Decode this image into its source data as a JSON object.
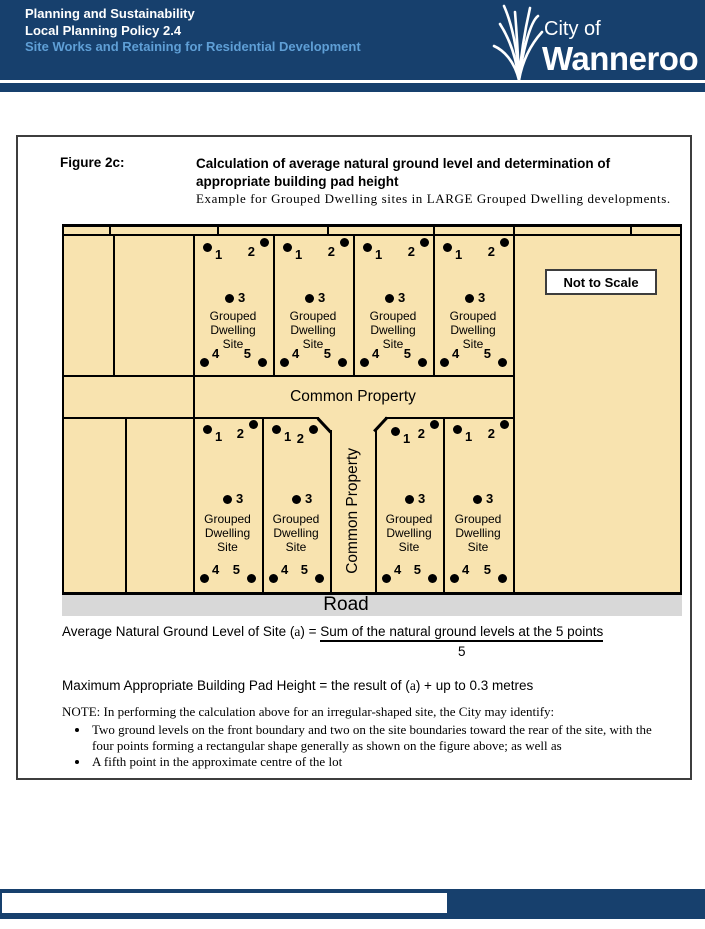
{
  "header": {
    "line1": "Planning and Sustainability",
    "line2": "Local Planning Policy 2.4",
    "line3": "Site Works and Retaining for Residential Development",
    "logo": {
      "city_of": "City of",
      "city_name": "Wanneroo"
    }
  },
  "figure": {
    "label": "Figure 2c:",
    "title_line1": "Calculation of average natural ground level and determination of",
    "title_line2": "appropriate building pad height",
    "subtitle": "Example for Grouped Dwelling sites in LARGE Grouped Dwelling developments."
  },
  "diagram": {
    "not_to_scale": "Not to Scale",
    "common_property_horizontal": "Common Property",
    "common_property_vertical": "Common Property",
    "road": "Road",
    "site_label_lines": [
      "Grouped",
      "Dwelling",
      "Site"
    ],
    "point_labels": [
      "1",
      "2",
      "3",
      "4",
      "5"
    ]
  },
  "formulas": {
    "avg_pre": "Average Natural Ground Level of Site (",
    "avg_a": "a",
    "avg_mid": ") = ",
    "numerator": "Sum of the natural ground levels at the 5 points",
    "denominator": "5",
    "max_pre": "Maximum Appropriate Building Pad Height = the result of (",
    "max_a": "a",
    "max_post": ") + up to 0.3 metres"
  },
  "note": {
    "intro": "NOTE: In performing the calculation above for an irregular-shaped site, the City may identify:",
    "bullets": [
      "Two ground levels on the front boundary and two on the site boundaries toward the rear of the site, with the four points forming a rectangular shape generally as shown on the figure above; as well as",
      "A fifth point in the approximate centre of the lot"
    ]
  },
  "colors": {
    "navy": "#17406d",
    "light_blue": "#5f9fd6",
    "cream": "#f8e3af",
    "road_gray": "#d8d8d8"
  }
}
